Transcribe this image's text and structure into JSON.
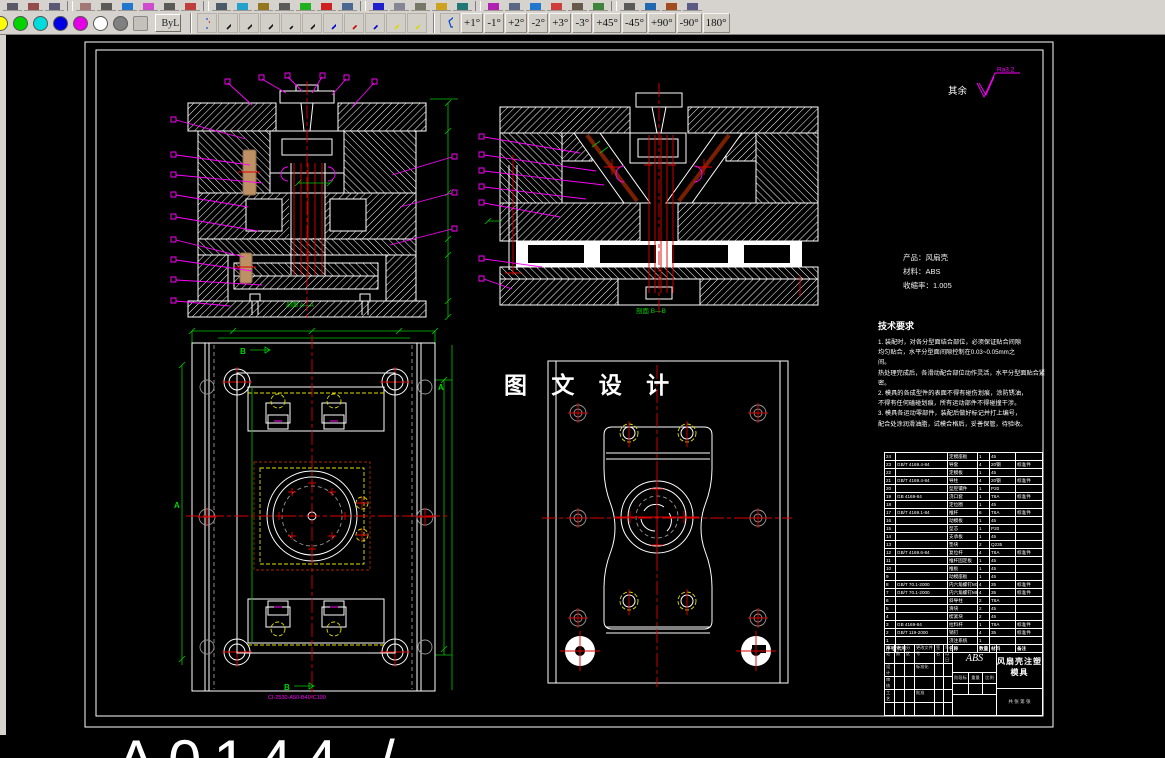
{
  "toolbar": {
    "row1_icons": [
      "#445",
      "#833",
      "#446",
      "|",
      "#966",
      "#444",
      "#06c",
      "#c3c",
      "#444",
      "#b22",
      "|",
      "#345",
      "#09c",
      "#860",
      "#444",
      "#0a0",
      "#c00",
      "#358",
      "|",
      "#00c",
      "#778",
      "#665",
      "#c90",
      "#066",
      "|",
      "#a0a",
      "#457",
      "#06c",
      "#c22",
      "#543",
      "#272",
      "|",
      "#444",
      "#05a",
      "#930",
      "#447"
    ],
    "colors": [
      {
        "name": "yellow",
        "hex": "#ffff00",
        "cut": true
      },
      {
        "name": "green",
        "hex": "#00d400"
      },
      {
        "name": "cyan",
        "hex": "#00dcdc"
      },
      {
        "name": "blue",
        "hex": "#0000e0"
      },
      {
        "name": "magenta",
        "hex": "#e400e4"
      },
      {
        "name": "white",
        "hex": "#ffffff"
      },
      {
        "name": "dark-gray",
        "hex": "#808080"
      },
      {
        "name": "light-gray",
        "hex": "#c4c1bb",
        "square": true
      }
    ],
    "byl_label": "ByL",
    "line_styles": [
      {
        "name": "line-width-tool",
        "special": true,
        "color": "#cc0000"
      },
      {
        "name": "solid-black",
        "color": "#111111",
        "dash": ""
      },
      {
        "name": "dashed-black",
        "color": "#111111",
        "dash": "6 3"
      },
      {
        "name": "dashdot-black",
        "color": "#111111",
        "dash": "8 2 2 2"
      },
      {
        "name": "dashed2-black",
        "color": "#111111",
        "dash": "4 2"
      },
      {
        "name": "dashdotdot-black",
        "color": "#111111",
        "dash": "7 2 2 2 2 2"
      },
      {
        "name": "solid-blue",
        "color": "#0000cc",
        "dash": ""
      },
      {
        "name": "dashed-red",
        "color": "#cc0000",
        "dash": "5 2"
      },
      {
        "name": "dashed-blue",
        "color": "#0000cc",
        "dash": "5 2"
      },
      {
        "name": "solid-yellow",
        "color": "#d8d800",
        "dash": ""
      },
      {
        "name": "dashed-yellow",
        "color": "#d8d800",
        "dash": "5 2"
      }
    ],
    "angle_buttons": [
      "+1°",
      "-1°",
      "+2°",
      "-2°",
      "+3°",
      "-3°",
      "+45°",
      "-45°",
      "+90°",
      "-90°",
      "180°"
    ]
  },
  "drawing": {
    "roughness_prefix": "其余",
    "roughness_value": "Ra3.2",
    "center_title": "图 文 设 计",
    "product_info": [
      "产品：风扇壳",
      "材料：ABS",
      "收缩率：1.005"
    ],
    "tech_req_title": "技术要求",
    "tech_req_lines": [
      "1. 装配时，对各分型面结合部位，必须保证贴合间隙",
      "均匀贴合，水平分型面间隙控制在0.03~0.05mm之",
      "间。",
      "热处理完成后，各滑动配合部位动作灵活，水平分型面贴合紧",
      "密。",
      "2. 模具的各成型件的表面不得有碰伤划痕，涂防锈油，",
      "不得有任何磕碰划痕，所有运动部件不得碰撞干涉。",
      "3. 模具各运动零部件，装配后做好标记并打上编号，",
      "配合处涂润滑油脂，试模合格后，妥善保管，待验收。"
    ],
    "section_a_label": "剖面 A—A",
    "section_b_label": "剖面 B—B",
    "marker_b": "B",
    "marker_a": "A",
    "moldbase_code": "CI-2530-A50-B40-C100",
    "bottom_partial_text": "A0144 /",
    "bom": {
      "headers": [
        "序号",
        "代号",
        "名称",
        "数量",
        "材料",
        "备注"
      ],
      "rows": [
        [
          "24",
          "",
          "定模座板",
          "1",
          "45",
          ""
        ],
        [
          "23",
          "GB/T 4169.4-84",
          "导套",
          "4",
          "20钢",
          "标准件"
        ],
        [
          "22",
          "",
          "定模板",
          "1",
          "45",
          ""
        ],
        [
          "21",
          "GB/T 4169.4-84",
          "导柱",
          "4",
          "20钢",
          "标准件"
        ],
        [
          "20",
          "",
          "型腔镶件",
          "1",
          "P20",
          ""
        ],
        [
          "19",
          "GB 4169-84",
          "浇口套",
          "1",
          "T8A",
          "标准件"
        ],
        [
          "18",
          "",
          "定位圈",
          "1",
          "45",
          ""
        ],
        [
          "17",
          "GB/T 4169.1-84",
          "推杆",
          "6",
          "T8A",
          "标准件"
        ],
        [
          "16",
          "",
          "动模板",
          "1",
          "45",
          ""
        ],
        [
          "15",
          "",
          "型芯",
          "1",
          "P20",
          ""
        ],
        [
          "14",
          "",
          "支承板",
          "1",
          "45",
          ""
        ],
        [
          "13",
          "",
          "垫块",
          "2",
          "Q235",
          ""
        ],
        [
          "12",
          "GB/T 4169.6-84",
          "复位杆",
          "4",
          "T8A",
          "标准件"
        ],
        [
          "11",
          "",
          "推杆固定板",
          "1",
          "45",
          ""
        ],
        [
          "10",
          "",
          "推板",
          "1",
          "45",
          ""
        ],
        [
          "9",
          "",
          "动模座板",
          "1",
          "45",
          ""
        ],
        [
          "8",
          "GB/T 70.1-2000",
          "内六角螺钉M10",
          "4",
          "35",
          "标准件"
        ],
        [
          "7",
          "GB/T 70.1-2000",
          "内六角螺钉M8",
          "4",
          "35",
          "标准件"
        ],
        [
          "6",
          "",
          "斜导柱",
          "2",
          "T8A",
          ""
        ],
        [
          "5",
          "",
          "滑块",
          "2",
          "45",
          ""
        ],
        [
          "4",
          "",
          "楔紧块",
          "2",
          "45",
          ""
        ],
        [
          "3",
          "GB 4169-84",
          "拉料杆",
          "1",
          "T8A",
          "标准件"
        ],
        [
          "2",
          "GB/T 119-2000",
          "销钉",
          "4",
          "35",
          "标准件"
        ],
        [
          "1",
          "",
          "浇注系统",
          "1",
          "",
          ""
        ]
      ]
    },
    "title_block": {
      "row1": [
        "标记",
        "处数",
        "分区",
        "更改文件号",
        "签名",
        "年月日"
      ],
      "left_rows": [
        [
          "设计",
          "",
          "",
          "标准化",
          "",
          ""
        ],
        [
          "审核",
          "",
          "",
          "",
          "",
          ""
        ],
        [
          "工艺",
          "",
          "",
          "批准",
          "",
          ""
        ],
        [
          "",
          "",
          "",
          "",
          "",
          ""
        ]
      ],
      "material": "ABS",
      "stage": "阶段标记",
      "weight": "重量",
      "scale": "比例",
      "name": "风扇壳注塑模具",
      "sheet": "共 张 第 张"
    }
  }
}
